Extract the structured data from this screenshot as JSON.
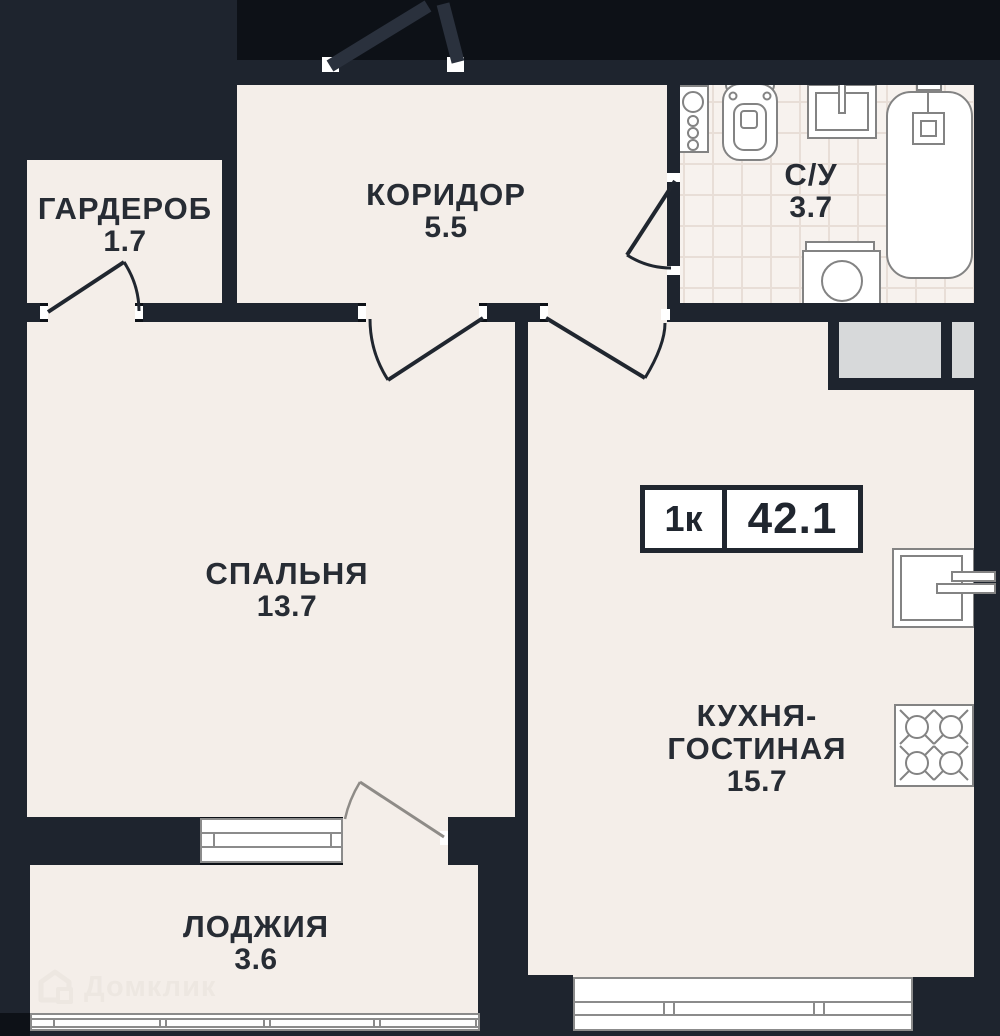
{
  "plan_title": "1-room apartment floor plan",
  "badge": {
    "rooms_label": "1к",
    "area_label": "42.1"
  },
  "rooms": [
    {
      "id": "garderob",
      "label": "ГАРДЕРОБ",
      "area": "1.7"
    },
    {
      "id": "koridor",
      "label": "КОРИДОР",
      "area": "5.5"
    },
    {
      "id": "su",
      "label": "С/У",
      "area": "3.7"
    },
    {
      "id": "spalnya",
      "label": "СПАЛЬНЯ",
      "area": "13.7"
    },
    {
      "id": "kuhnya-gostinaya",
      "label_line1": "КУХНЯ-",
      "label_line2": "ГОСТИНАЯ",
      "area": "15.7"
    },
    {
      "id": "lodzhiya",
      "label": "ЛОДЖИЯ",
      "area": "3.6"
    }
  ],
  "watermark": {
    "text": "Домклик"
  },
  "colors": {
    "background": "#0d1117",
    "wall": "#1e242e",
    "floor": "#f4eee9",
    "bath_floor": "#f7f2ee",
    "fixture_stroke": "#838383",
    "shaft_gray": "#d7d9da",
    "text": "#272c34",
    "badge_border": "#20262f",
    "watermark": "#ece6e0"
  }
}
